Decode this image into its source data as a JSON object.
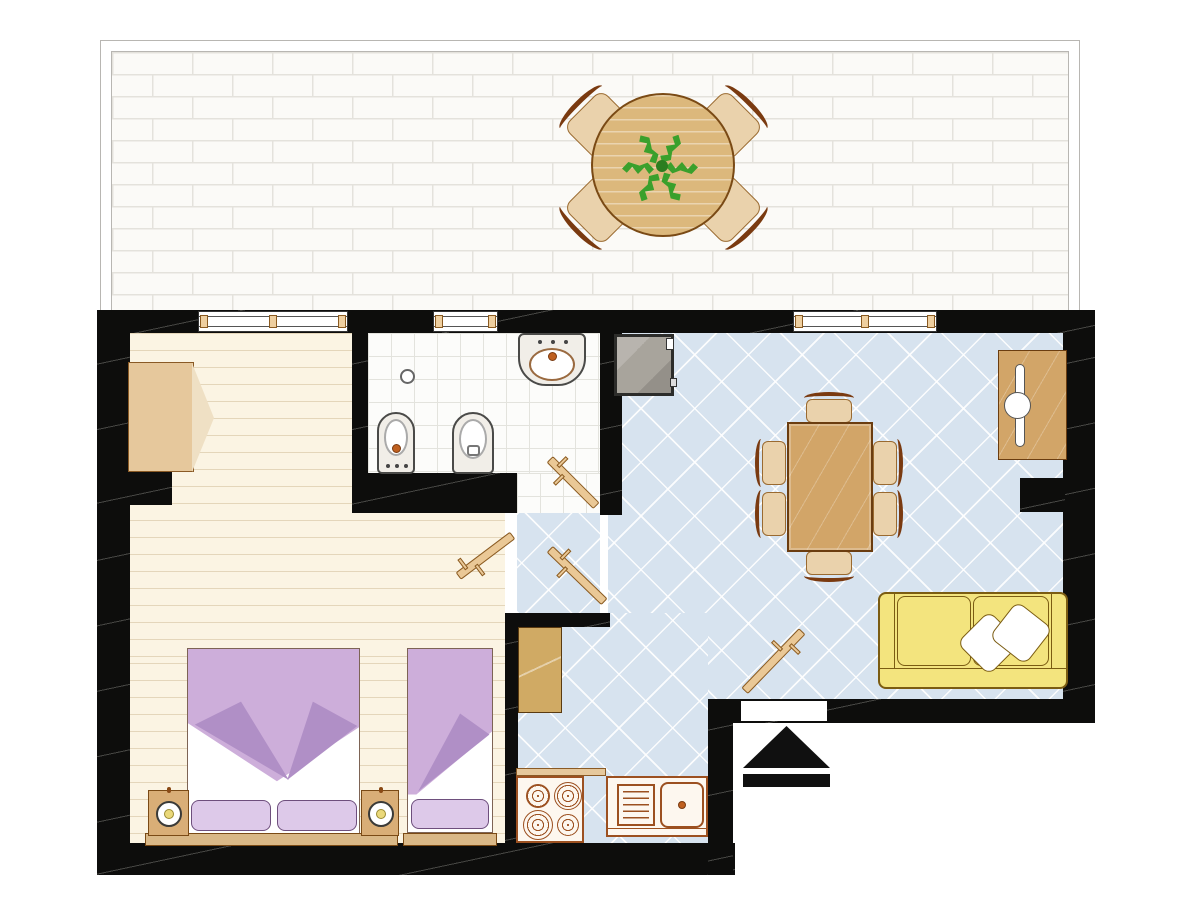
{
  "meta": {
    "type": "floor-plan",
    "description": "Top-down architectural floor plan of an apartment with terrace"
  },
  "rooms": {
    "terrace": {
      "label": "Terrace"
    },
    "bedroom": {
      "label": "Bedroom"
    },
    "bathroom": {
      "label": "Bathroom"
    },
    "hall": {
      "label": "Hallway"
    },
    "living": {
      "label": "Living and dining room"
    },
    "kitchen": {
      "label": "Kitchen area"
    }
  },
  "furniture": {
    "terrace_table": {
      "label": "Round terrace table with plant",
      "chairs": 4
    },
    "wardrobe": {
      "label": "Wardrobe with open doors"
    },
    "double_bed": {
      "label": "Double bed",
      "pillows": 2
    },
    "single_bed": {
      "label": "Single bed",
      "pillows": 1
    },
    "nightstands": {
      "label": "Nightstand with lamp",
      "count": 2
    },
    "sink": {
      "label": "Bathroom sink"
    },
    "bidet": {
      "label": "Bidet"
    },
    "toilet": {
      "label": "Toilet"
    },
    "washer": {
      "label": "Washing machine"
    },
    "dining_table": {
      "label": "Dining table",
      "chairs": 6
    },
    "sofa": {
      "label": "Sofa",
      "pillows": 2
    },
    "desk": {
      "label": "Desk"
    },
    "cabinet": {
      "label": "Hall cabinet"
    },
    "stove": {
      "label": "Stove",
      "burners": 4
    },
    "kitchen_sink": {
      "label": "Kitchen counter with sink"
    },
    "entrance_arrow": {
      "label": "Entrance direction marker"
    },
    "doors": {
      "label": "Interior door",
      "count": 5
    }
  },
  "colors": {
    "wall": "#0d0d0c",
    "mortar": "#e4e2dc",
    "plank": "#fbf4e3",
    "tile": "#fcfcfa",
    "blue": "#d7e3ef",
    "wood": "#d2a568",
    "woodlight": "#ecd6b4",
    "woodborder": "#9a6a30",
    "wooddark": "#6b3d10",
    "doorwood": "#eac896",
    "ttable": "#dcb87c",
    "seat": "#ead2ac",
    "seatback": "#7a3a10",
    "blanket": "#cdaeda",
    "fold": "#b08fc6",
    "pillow": "#ddc9e9",
    "pborder": "#6e4f7d",
    "sofa": "#f3e47e",
    "sofaborder": "#7b5c12",
    "machine": "#a8a49c",
    "fixborder": "#4a4a48",
    "appl": "#9c5020",
    "orange": "#bf6020",
    "lamp": "#ead87a",
    "plant": "#3aa02c",
    "ink": "#101010"
  }
}
